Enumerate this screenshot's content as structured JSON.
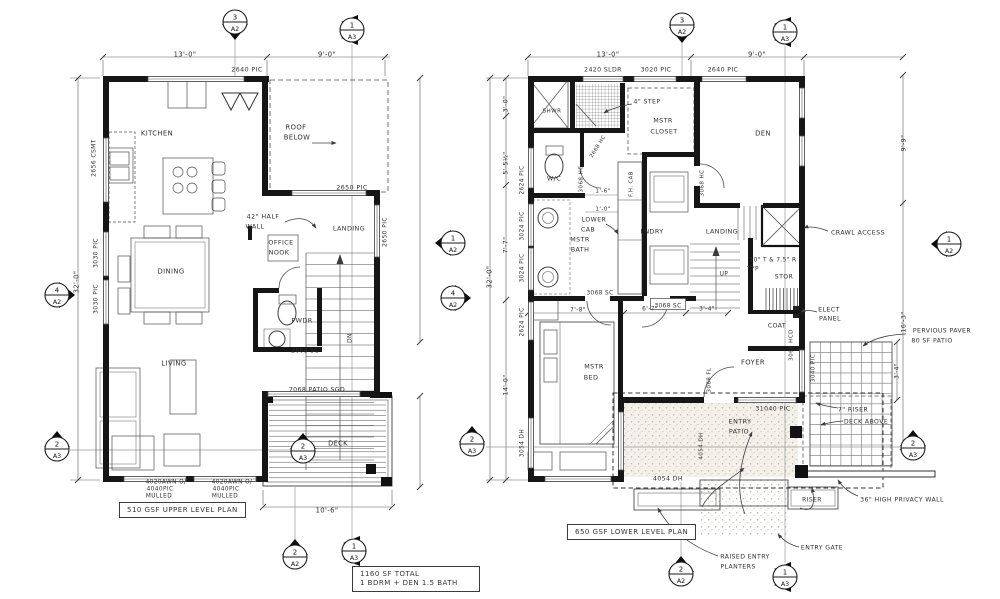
{
  "drawing": {
    "upper_plan_title": "510 GSF UPPER LEVEL PLAN",
    "lower_plan_title": "650 GSF LOWER LEVEL PLAN",
    "total_note_line1": "1160 SF TOTAL",
    "total_note_line2": "1 BDRM + DEN 1.5 BATH"
  },
  "colors": {
    "ink": "#2f2f2f",
    "wall": "#161616",
    "thin": "#5a5a5a",
    "light": "#8a8a8a",
    "paper": "#ffffff"
  },
  "labels": [
    {
      "t": "13'-0\"",
      "x": 185,
      "y": 54
    },
    {
      "t": "9'-0\"",
      "x": 327,
      "y": 54
    },
    {
      "t": "2640 PIC",
      "x": 247,
      "y": 69,
      "s": 6.3
    },
    {
      "t": "2656 CSMT",
      "x": 93,
      "y": 158,
      "r": -90,
      "s": 6
    },
    {
      "t": "3030 PIC",
      "x": 95,
      "y": 253,
      "r": -90,
      "s": 6
    },
    {
      "t": "3030 PIC",
      "x": 95,
      "y": 299,
      "r": -90,
      "s": 6
    },
    {
      "t": "32'-0\"",
      "x": 76,
      "y": 282,
      "r": -90
    },
    {
      "t": "KITCHEN",
      "x": 157,
      "y": 133
    },
    {
      "t": "ROOF",
      "x": 296,
      "y": 127
    },
    {
      "t": "BELOW",
      "x": 297,
      "y": 137
    },
    {
      "t": "2650 PIC",
      "x": 352,
      "y": 187,
      "s": 6.3
    },
    {
      "t": "2650 PIC",
      "x": 384,
      "y": 232,
      "r": -90,
      "s": 6
    },
    {
      "t": "42\" HALF",
      "x": 263,
      "y": 216,
      "s": 6.4
    },
    {
      "t": "WALL",
      "x": 255,
      "y": 226,
      "s": 6.4
    },
    {
      "t": "LANDING",
      "x": 349,
      "y": 228,
      "s": 6.4
    },
    {
      "t": "OFFICE",
      "x": 281,
      "y": 242,
      "s": 6.4
    },
    {
      "t": "NOOK",
      "x": 279,
      "y": 252,
      "s": 6.4
    },
    {
      "t": "DINING",
      "x": 171,
      "y": 271
    },
    {
      "t": "PWDR",
      "x": 302,
      "y": 320,
      "s": 6.4
    },
    {
      "t": "LIVING",
      "x": 174,
      "y": 363
    },
    {
      "t": "2668 SC",
      "x": 305,
      "y": 350,
      "s": 6
    },
    {
      "t": "DN",
      "x": 349,
      "y": 338,
      "r": -90,
      "s": 6
    },
    {
      "t": "7068 PATIO SGD",
      "x": 317,
      "y": 389,
      "s": 6.2
    },
    {
      "t": "DECK",
      "x": 338,
      "y": 443,
      "s": 6.6
    },
    {
      "t": "4020AWN O/",
      "x": 166,
      "y": 481,
      "s": 5.8
    },
    {
      "t": "4040PIC",
      "x": 160,
      "y": 488,
      "s": 5.8
    },
    {
      "t": "MULLED",
      "x": 159,
      "y": 495,
      "s": 5.8
    },
    {
      "t": "4020AWN O/",
      "x": 232,
      "y": 481,
      "s": 5.8
    },
    {
      "t": "4040PIC",
      "x": 226,
      "y": 488,
      "s": 5.8
    },
    {
      "t": "MULLED",
      "x": 225,
      "y": 495,
      "s": 5.8
    },
    {
      "t": "10'-6\"",
      "x": 327,
      "y": 510
    },
    {
      "t": "13'-0\"",
      "x": 608,
      "y": 54
    },
    {
      "t": "9'-0\"",
      "x": 757,
      "y": 54
    },
    {
      "t": "2420 SLDR",
      "x": 603,
      "y": 69,
      "s": 6.2
    },
    {
      "t": "3020 PIC",
      "x": 656,
      "y": 69,
      "s": 6.2
    },
    {
      "t": "2640 PIC",
      "x": 723,
      "y": 69,
      "s": 6.2
    },
    {
      "t": "3'-0\"",
      "x": 505,
      "y": 104,
      "r": -90,
      "s": 6.2
    },
    {
      "t": "5'-5½\"",
      "x": 505,
      "y": 163,
      "r": -90,
      "s": 6.2
    },
    {
      "t": "7'-7\"",
      "x": 505,
      "y": 245,
      "r": -90,
      "s": 6.2
    },
    {
      "t": "14'-0\"",
      "x": 505,
      "y": 385,
      "r": -90,
      "s": 6.2
    },
    {
      "t": "32'-0\"",
      "x": 489,
      "y": 277,
      "r": -90
    },
    {
      "t": "2624 PIC",
      "x": 521,
      "y": 180,
      "r": -90,
      "s": 5.8
    },
    {
      "t": "3024 PIC",
      "x": 521,
      "y": 226,
      "r": -90,
      "s": 5.8
    },
    {
      "t": "3024 PIC",
      "x": 521,
      "y": 268,
      "r": -90,
      "s": 5.8
    },
    {
      "t": "2624 PIC",
      "x": 521,
      "y": 322,
      "r": -90,
      "s": 5.8
    },
    {
      "t": "3054 DH",
      "x": 521,
      "y": 443,
      "r": -90,
      "s": 5.8
    },
    {
      "t": "SHWR",
      "x": 552,
      "y": 110,
      "s": 5.6
    },
    {
      "t": "4\" STEP",
      "x": 647,
      "y": 101,
      "s": 6.2
    },
    {
      "t": "MSTR",
      "x": 663,
      "y": 120,
      "s": 6.4
    },
    {
      "t": "CLOSET",
      "x": 664,
      "y": 131,
      "s": 6.4
    },
    {
      "t": "DEN",
      "x": 763,
      "y": 133
    },
    {
      "t": "W/C",
      "x": 554,
      "y": 178,
      "s": 6.4
    },
    {
      "t": "2668 HC",
      "x": 597,
      "y": 146,
      "r": -58,
      "s": 5.2
    },
    {
      "t": "3068 HC",
      "x": 580,
      "y": 179,
      "r": -90,
      "s": 5.6
    },
    {
      "t": "1'-6\"",
      "x": 603,
      "y": 190,
      "s": 5.6
    },
    {
      "t": "1'-0\"",
      "x": 603,
      "y": 208,
      "s": 5.6
    },
    {
      "t": "F.H. CAB",
      "x": 630,
      "y": 184,
      "r": -90,
      "s": 5.4
    },
    {
      "t": "3068 HC",
      "x": 701,
      "y": 183,
      "r": -90,
      "s": 5.6
    },
    {
      "t": "LOWER",
      "x": 594,
      "y": 219,
      "s": 6.2
    },
    {
      "t": "CAB",
      "x": 588,
      "y": 229,
      "s": 6.2
    },
    {
      "t": "MSTR",
      "x": 580,
      "y": 239,
      "s": 6.4
    },
    {
      "t": "BATH",
      "x": 580,
      "y": 249,
      "s": 6.4
    },
    {
      "t": "LNDRY",
      "x": 652,
      "y": 231,
      "s": 6.4
    },
    {
      "t": "LANDING",
      "x": 722,
      "y": 231,
      "s": 6.4
    },
    {
      "t": "UP",
      "x": 724,
      "y": 273,
      "s": 5.8
    },
    {
      "t": "10\" T & 7.5\" R",
      "x": 773,
      "y": 259,
      "s": 5.8
    },
    {
      "t": "TYP",
      "x": 753,
      "y": 268,
      "s": 5.8
    },
    {
      "t": "STOR",
      "x": 784,
      "y": 276,
      "s": 6.2
    },
    {
      "t": "COAT",
      "x": 777,
      "y": 325,
      "s": 6.2
    },
    {
      "t": "CRAWL ACCESS",
      "x": 858,
      "y": 232,
      "s": 6.3
    },
    {
      "t": "ELECT",
      "x": 829,
      "y": 309,
      "s": 6.3
    },
    {
      "t": "PANEL",
      "x": 830,
      "y": 318,
      "s": 6.3
    },
    {
      "t": "3068 SC",
      "x": 600,
      "y": 292,
      "s": 5.8
    },
    {
      "t": "3068 SC",
      "x": 668,
      "y": 305,
      "s": 5.8,
      "b": 1
    },
    {
      "t": "7'-8\"",
      "x": 578,
      "y": 309,
      "s": 5.8
    },
    {
      "t": "6'-7\"",
      "x": 650,
      "y": 308,
      "s": 5.8
    },
    {
      "t": "3'-4\"",
      "x": 707,
      "y": 308,
      "s": 5.8
    },
    {
      "t": "3068 HCD",
      "x": 790,
      "y": 345,
      "r": -90,
      "s": 5.6
    },
    {
      "t": "3040 PIC",
      "x": 812,
      "y": 368,
      "r": -90,
      "s": 5.6
    },
    {
      "t": "FOYER",
      "x": 753,
      "y": 362
    },
    {
      "t": "MSTR",
      "x": 594,
      "y": 366,
      "s": 6.4
    },
    {
      "t": "BED",
      "x": 591,
      "y": 377,
      "s": 6.4
    },
    {
      "t": "3068 FL",
      "x": 708,
      "y": 380,
      "r": -90,
      "s": 5.6
    },
    {
      "t": "ENTRY",
      "x": 740,
      "y": 421,
      "s": 6.4
    },
    {
      "t": "PATIO",
      "x": 739,
      "y": 431,
      "s": 6.4
    },
    {
      "t": "31040 PIC",
      "x": 773,
      "y": 408,
      "s": 6.2
    },
    {
      "t": "4054 DH",
      "x": 700,
      "y": 446,
      "r": -90,
      "s": 5.6
    },
    {
      "t": "3054 DH",
      "x": 527,
      "y": 443,
      "r": -90,
      "s": 0
    },
    {
      "t": "4054 DH",
      "x": 668,
      "y": 478,
      "s": 6.2
    },
    {
      "t": "PERVIOUS PAVER",
      "x": 942,
      "y": 330,
      "s": 6.2
    },
    {
      "t": "80 SF PATIO",
      "x": 932,
      "y": 340,
      "s": 6.2
    },
    {
      "t": "7\" RISER",
      "x": 853,
      "y": 409,
      "s": 6.2
    },
    {
      "t": "DECK ABOVE",
      "x": 866,
      "y": 421,
      "s": 6.2
    },
    {
      "t": "RISER",
      "x": 812,
      "y": 499,
      "s": 6
    },
    {
      "t": "36\" HIGH PRIVACY WALL",
      "x": 902,
      "y": 499,
      "s": 6.2
    },
    {
      "t": "ENTRY GATE",
      "x": 822,
      "y": 547,
      "s": 6.2
    },
    {
      "t": "RAISED ENTRY",
      "x": 745,
      "y": 556,
      "s": 6.2
    },
    {
      "t": "PLANTERS",
      "x": 738,
      "y": 566,
      "s": 6.2
    },
    {
      "t": "9'-9\"",
      "x": 903,
      "y": 143,
      "r": -90,
      "s": 6.2
    },
    {
      "t": "16'-3\"",
      "x": 903,
      "y": 322,
      "r": -90,
      "s": 6.2
    },
    {
      "t": "3'-4\"",
      "x": 896,
      "y": 371,
      "r": -90,
      "s": 5.8
    }
  ],
  "markers": [
    {
      "n": "3",
      "sh": "A2",
      "x": 235,
      "y": 22,
      "d": "down"
    },
    {
      "n": "1",
      "sh": "A3",
      "x": 352,
      "y": 30,
      "d": "vleft"
    },
    {
      "n": "4",
      "sh": "A2",
      "x": 57,
      "y": 295,
      "d": "right"
    },
    {
      "n": "2",
      "sh": "A3",
      "x": 57,
      "y": 449,
      "d": "up"
    },
    {
      "n": "2",
      "sh": "A3",
      "x": 303,
      "y": 451,
      "d": "up"
    },
    {
      "n": "1",
      "sh": "A2",
      "x": 453,
      "y": 243,
      "d": "left"
    },
    {
      "n": "4",
      "sh": "A2",
      "x": 453,
      "y": 298,
      "d": "right"
    },
    {
      "n": "2",
      "sh": "A2",
      "x": 295,
      "y": 557,
      "d": "up"
    },
    {
      "n": "1",
      "sh": "A3",
      "x": 354,
      "y": 551,
      "d": "vleft"
    },
    {
      "n": "3",
      "sh": "A2",
      "x": 682,
      "y": 25,
      "d": "down"
    },
    {
      "n": "1",
      "sh": "A3",
      "x": 785,
      "y": 32,
      "d": "vleft"
    },
    {
      "n": "2",
      "sh": "A3",
      "x": 472,
      "y": 444,
      "d": "up"
    },
    {
      "n": "1",
      "sh": "A2",
      "x": 949,
      "y": 244,
      "d": "left"
    },
    {
      "n": "2",
      "sh": "A3",
      "x": 913,
      "y": 448,
      "d": "up"
    },
    {
      "n": "2",
      "sh": "A2",
      "x": 681,
      "y": 574,
      "d": "up"
    },
    {
      "n": "1",
      "sh": "A3",
      "x": 785,
      "y": 577,
      "d": "vleft"
    }
  ]
}
